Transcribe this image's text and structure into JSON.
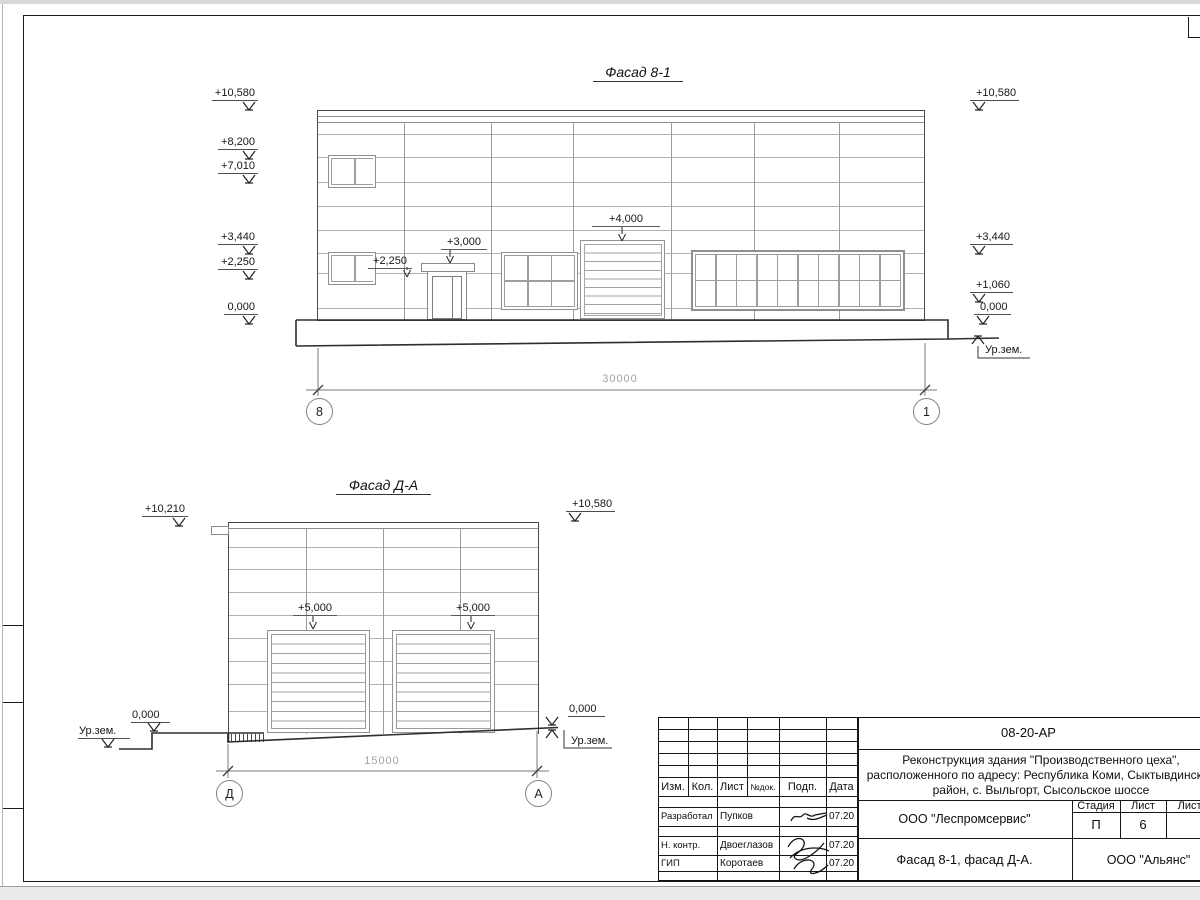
{
  "facade1": {
    "title": "Фасад 8-1",
    "left_marks": [
      "+10,580",
      "+8,200",
      "+7,010",
      "+3,440",
      "+2,250",
      "0,000"
    ],
    "right_marks": [
      "+10,580",
      "+3,440",
      "+1,060",
      "0,000"
    ],
    "ground_label": "Ур.зем.",
    "ann_sill": "+2,250",
    "ann_door": "+3,000",
    "ann_gate": "+4,000",
    "dim": "30000",
    "axis_left": "8",
    "axis_right": "1"
  },
  "facade2": {
    "title": "Фасад Д-А",
    "left_mark": "+10,210",
    "right_mark": "+10,580",
    "gate_mark_left": "+5,000",
    "gate_mark_right": "+5,000",
    "zero_left": "0,000",
    "zero_right": "0,000",
    "ground_left": "Ур.зем.",
    "ground_right": "Ур.зем.",
    "dim": "15000",
    "axis_left": "Д",
    "axis_right": "А"
  },
  "titleblock": {
    "code": "08-20-АР",
    "project_line1": "Реконструкция здания \"Производственного цеха\",",
    "project_line2": "расположенного по адресу: Республика Коми, Сыктывдинский",
    "project_line3": "район, с. Выльгорт, Сысольское шоссе",
    "cols": {
      "izm": "Изм.",
      "kol": "Кол.",
      "list": "Лист",
      "ndok": "№док.",
      "podp": "Подп.",
      "data": "Дата"
    },
    "stage_label": "Стадия",
    "list_label": "Лист",
    "listov_label": "Листов",
    "stage": "П",
    "sheet": "6",
    "org1": "ООО \"Леспромсервис\"",
    "org2": "ООО \"Альянс\"",
    "doc_title": "Фасад 8-1, фасад Д-А.",
    "rows": [
      {
        "role": "Разработал",
        "name": "Пупков",
        "date": "07.20"
      },
      {
        "role": "Н. контр.",
        "name": "Двоеглазов",
        "date": "07.20"
      },
      {
        "role": "ГИП",
        "name": "Коротаев",
        "date": "07.20"
      }
    ]
  }
}
